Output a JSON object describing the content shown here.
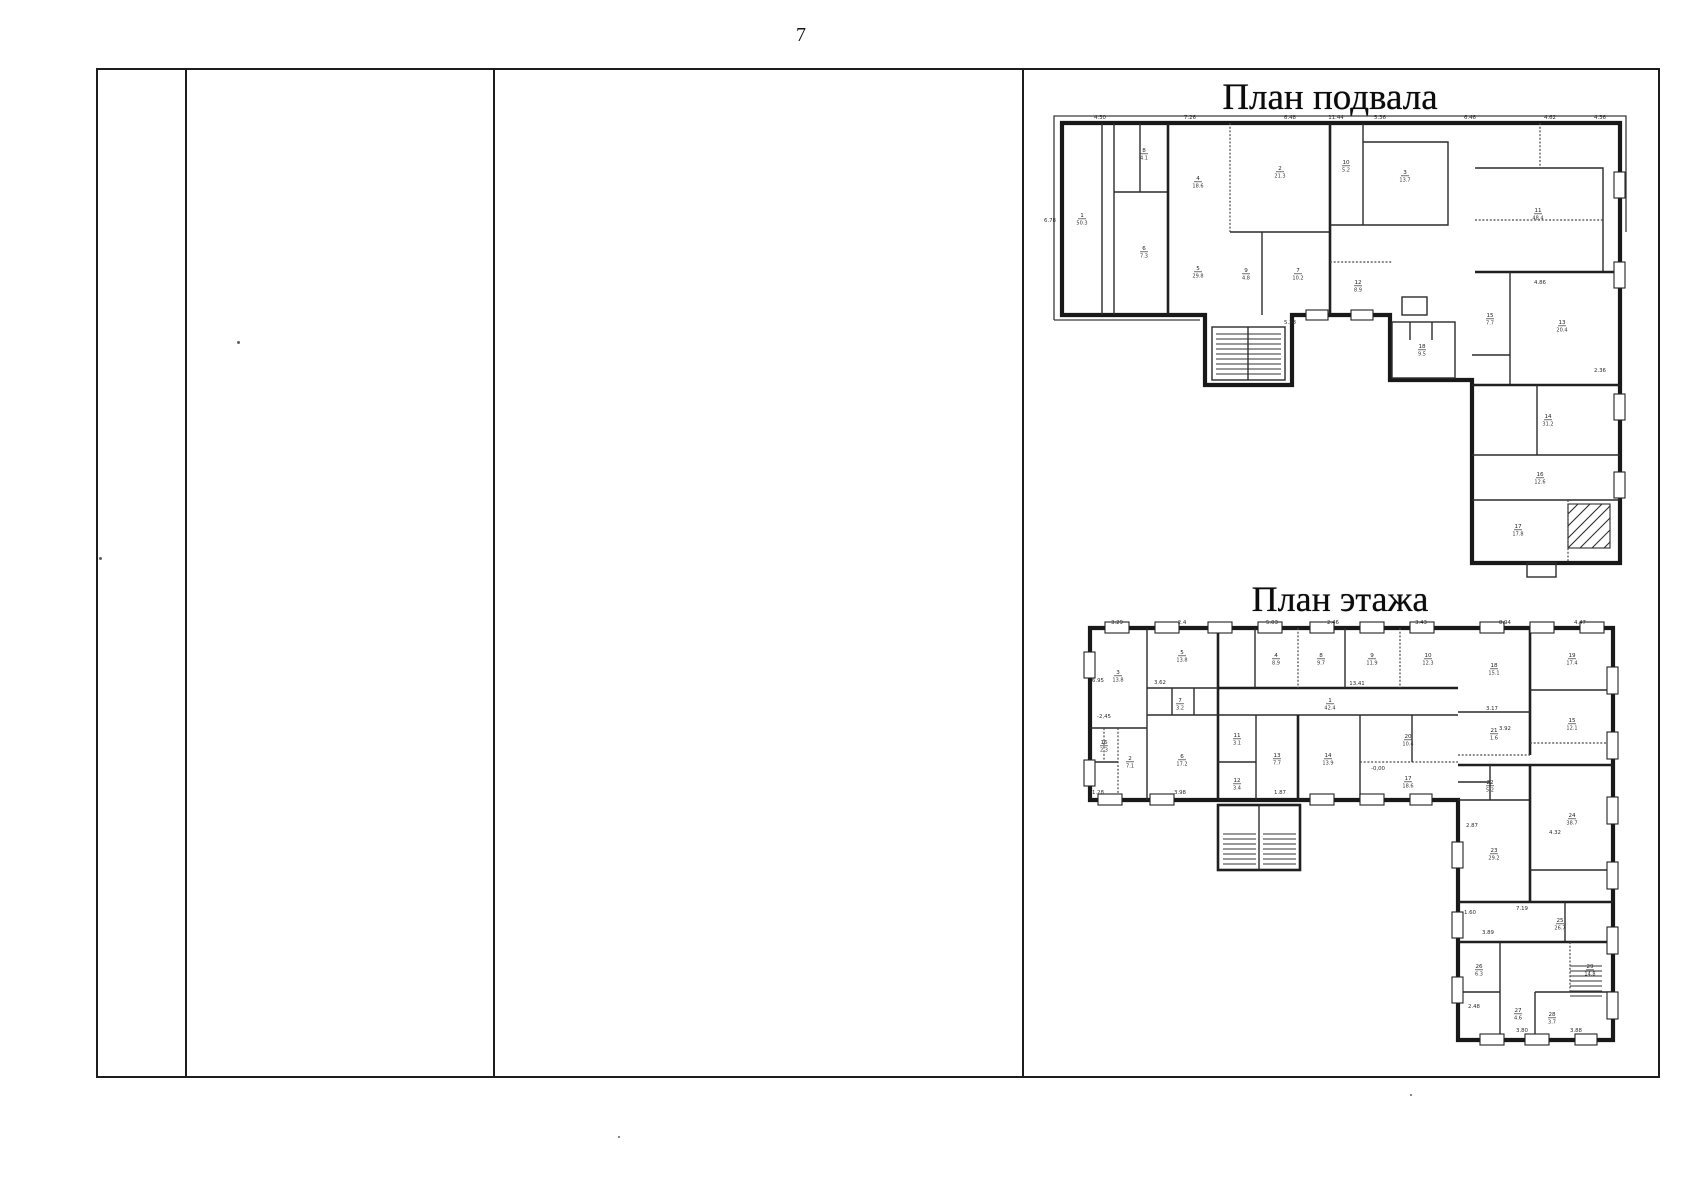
{
  "page": {
    "number": "7"
  },
  "table": {
    "column_count": 4
  },
  "figures": {
    "basement": {
      "title": "План подвала",
      "dims": [
        {
          "t": "11.44",
          "x": 296,
          "y": 7
        },
        {
          "t": "4.30",
          "x": 60,
          "y": 7
        },
        {
          "t": "7.26",
          "x": 150,
          "y": 7
        },
        {
          "t": "6.48",
          "x": 250,
          "y": 7
        },
        {
          "t": "5.36",
          "x": 340,
          "y": 7
        },
        {
          "t": "6.46",
          "x": 430,
          "y": 7
        },
        {
          "t": "4.62",
          "x": 510,
          "y": 7
        },
        {
          "t": "4.36",
          "x": 560,
          "y": 7
        },
        {
          "t": "6.78",
          "x": 10,
          "y": 110
        },
        {
          "t": "4.86",
          "x": 500,
          "y": 172
        },
        {
          "t": "5.28",
          "x": 250,
          "y": 212
        },
        {
          "t": "2.36",
          "x": 560,
          "y": 260
        }
      ],
      "rooms": [
        {
          "n": "1",
          "a": "50.3",
          "x": 42,
          "y": 105
        },
        {
          "n": "8",
          "a": "4.1",
          "x": 104,
          "y": 40
        },
        {
          "n": "6",
          "a": "7.3",
          "x": 104,
          "y": 138
        },
        {
          "n": "4",
          "a": "18.6",
          "x": 158,
          "y": 68
        },
        {
          "n": "5",
          "a": "29.8",
          "x": 158,
          "y": 158
        },
        {
          "n": "2",
          "a": "21.3",
          "x": 240,
          "y": 58
        },
        {
          "n": "9",
          "a": "4.8",
          "x": 206,
          "y": 160
        },
        {
          "n": "7",
          "a": "10.2",
          "x": 258,
          "y": 160
        },
        {
          "n": "10",
          "a": "5.2",
          "x": 306,
          "y": 52
        },
        {
          "n": "3",
          "a": "13.7",
          "x": 365,
          "y": 62
        },
        {
          "n": "12",
          "a": "8.9",
          "x": 318,
          "y": 172
        },
        {
          "n": "11",
          "a": "48.4",
          "x": 498,
          "y": 100
        },
        {
          "n": "13",
          "a": "20.4",
          "x": 522,
          "y": 212
        },
        {
          "n": "15",
          "a": "7.7",
          "x": 450,
          "y": 205
        },
        {
          "n": "14",
          "a": "31.2",
          "x": 508,
          "y": 306
        },
        {
          "n": "16",
          "a": "12.6",
          "x": 500,
          "y": 364
        },
        {
          "n": "17",
          "a": "17.8",
          "x": 478,
          "y": 416
        },
        {
          "n": "18",
          "a": "9.5",
          "x": 382,
          "y": 236
        }
      ]
    },
    "floor": {
      "title": "План этажа",
      "dims": [
        {
          "t": "3.29",
          "x": 57,
          "y": 12
        },
        {
          "t": "2.4",
          "x": 122,
          "y": 12
        },
        {
          "t": "5.03",
          "x": 212,
          "y": 12
        },
        {
          "t": "2.46",
          "x": 273,
          "y": 12
        },
        {
          "t": "3.43",
          "x": 361,
          "y": 12
        },
        {
          "t": "8.94",
          "x": 445,
          "y": 12
        },
        {
          "t": "4.47",
          "x": 520,
          "y": 12
        },
        {
          "t": "6.95",
          "x": 38,
          "y": 70
        },
        {
          "t": "3.62",
          "x": 100,
          "y": 72
        },
        {
          "t": "13.41",
          "x": 297,
          "y": 73
        },
        {
          "t": "-2,45",
          "x": 44,
          "y": 106
        },
        {
          "t": "3.17",
          "x": 432,
          "y": 98
        },
        {
          "t": "3.92",
          "x": 445,
          "y": 118
        },
        {
          "t": "-0,00",
          "x": 318,
          "y": 158
        },
        {
          "t": "1.87",
          "x": 220,
          "y": 182
        },
        {
          "t": "3.98",
          "x": 120,
          "y": 182
        },
        {
          "t": "1.28",
          "x": 38,
          "y": 182
        },
        {
          "t": "2.87",
          "x": 412,
          "y": 215
        },
        {
          "t": "4.32",
          "x": 495,
          "y": 222
        },
        {
          "t": "7.19",
          "x": 462,
          "y": 298
        },
        {
          "t": "3.89",
          "x": 428,
          "y": 322
        },
        {
          "t": "1.60",
          "x": 410,
          "y": 302
        },
        {
          "t": "2.48",
          "x": 414,
          "y": 396
        },
        {
          "t": "3.80",
          "x": 462,
          "y": 420
        },
        {
          "t": "3.88",
          "x": 516,
          "y": 420
        }
      ],
      "rooms": [
        {
          "n": "1",
          "a": "42.4",
          "x": 270,
          "y": 90
        },
        {
          "n": "2",
          "a": "7.1",
          "x": 70,
          "y": 148
        },
        {
          "n": "3",
          "a": "13.8",
          "x": 58,
          "y": 62
        },
        {
          "n": "4",
          "a": "8.9",
          "x": 216,
          "y": 45
        },
        {
          "n": "5",
          "a": "13.8",
          "x": 122,
          "y": 42
        },
        {
          "n": "6",
          "a": "17.2",
          "x": 122,
          "y": 146
        },
        {
          "n": "7",
          "a": "3.2",
          "x": 120,
          "y": 90
        },
        {
          "n": "8",
          "a": "9.7",
          "x": 261,
          "y": 45
        },
        {
          "n": "9",
          "a": "11.9",
          "x": 312,
          "y": 45
        },
        {
          "n": "10",
          "a": "12.3",
          "x": 368,
          "y": 45
        },
        {
          "n": "11",
          "a": "3.1",
          "x": 177,
          "y": 125
        },
        {
          "n": "12",
          "a": "3.4",
          "x": 177,
          "y": 170
        },
        {
          "n": "13",
          "a": "7.7",
          "x": 217,
          "y": 145
        },
        {
          "n": "14",
          "a": "13.9",
          "x": 268,
          "y": 145
        },
        {
          "n": "20",
          "a": "10.4",
          "x": 348,
          "y": 126
        },
        {
          "n": "16",
          "a": "2.3",
          "x": 44,
          "y": 132
        },
        {
          "n": "17",
          "a": "18.6",
          "x": 348,
          "y": 168
        },
        {
          "n": "18",
          "a": "15.1",
          "x": 434,
          "y": 55
        },
        {
          "n": "19",
          "a": "17.4",
          "x": 512,
          "y": 45
        },
        {
          "n": "15",
          "a": "12.1",
          "x": 512,
          "y": 110
        },
        {
          "n": "21",
          "a": "1.6",
          "x": 434,
          "y": 120
        },
        {
          "n": "22",
          "a": "5.2",
          "x": 430,
          "y": 172
        },
        {
          "n": "23",
          "a": "29.2",
          "x": 434,
          "y": 240
        },
        {
          "n": "24",
          "a": "38.7",
          "x": 512,
          "y": 205
        },
        {
          "n": "25",
          "a": "26.7",
          "x": 500,
          "y": 310
        },
        {
          "n": "26",
          "a": "6.3",
          "x": 419,
          "y": 356
        },
        {
          "n": "27",
          "a": "4.6",
          "x": 458,
          "y": 400
        },
        {
          "n": "28",
          "a": "3.7",
          "x": 492,
          "y": 404
        },
        {
          "n": "29",
          "a": "14.8",
          "x": 530,
          "y": 356
        }
      ]
    }
  }
}
